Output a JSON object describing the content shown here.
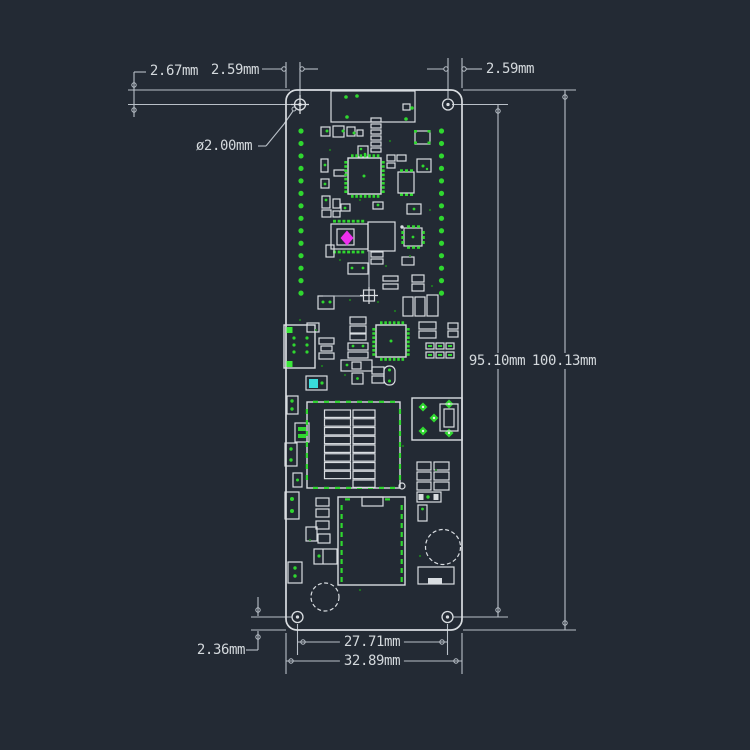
{
  "title": "PCB board dimension drawing",
  "colors": {
    "background": "#232a34",
    "drawing_line": "#d9dde1",
    "dimension_line": "#b9c0c8",
    "text": "#d3d8dc",
    "pad_green": "#2fd72f",
    "pad_green_bright": "#3ae83a",
    "marker_magenta": "#ee2fee",
    "component_cyan": "#39dcdc"
  },
  "labels": {
    "top_offset": "2.67mm",
    "hole_inset_left": "2.59mm",
    "hole_inset_right": "2.59mm",
    "hole_diameter": "ø2.00mm",
    "hole_span_vertical": "95.10mm",
    "board_height": "100.13mm",
    "bottom_offset": "2.36mm",
    "hole_span_horizontal": "27.71mm",
    "board_width": "32.89mm"
  }
}
